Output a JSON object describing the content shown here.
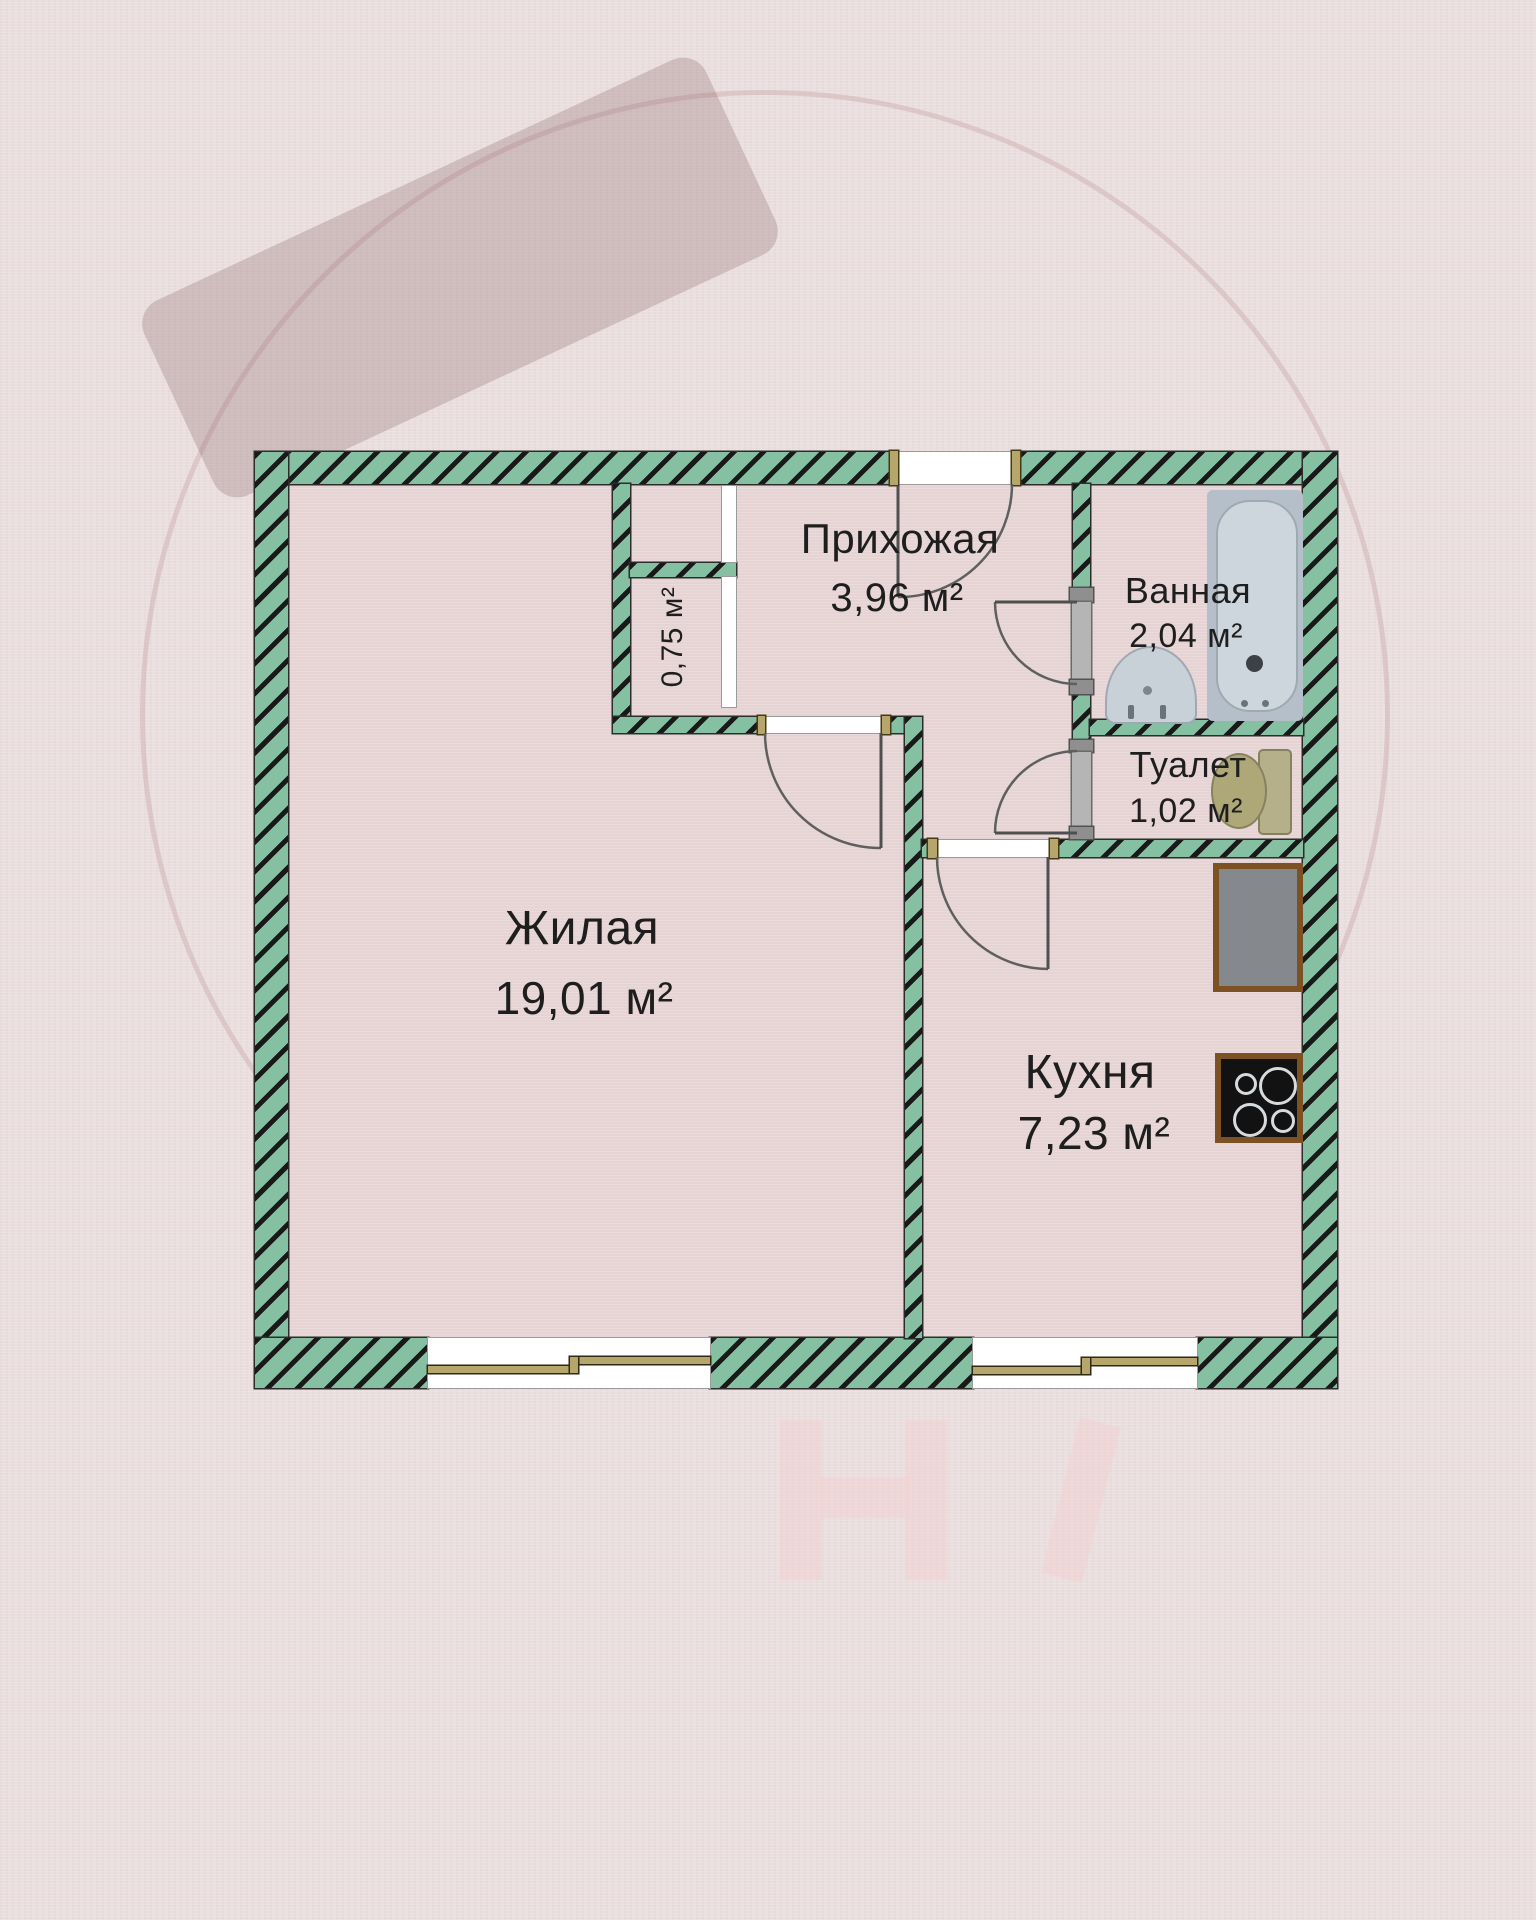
{
  "title": "Floor plan",
  "rooms": [
    {
      "id": "hallway",
      "name": "Прихожая",
      "area": "3,96 м²"
    },
    {
      "id": "bathroom",
      "name": "Ванная",
      "area": "2,04 м²"
    },
    {
      "id": "toilet",
      "name": "Туалет",
      "area": "1,02 м²"
    },
    {
      "id": "living",
      "name": "Жилая",
      "area": "19,01 м²"
    },
    {
      "id": "kitchen",
      "name": "Кухня",
      "area": "7,23 м²"
    },
    {
      "id": "closet",
      "name": "",
      "area": "0,75 м²"
    }
  ],
  "colors": {
    "bg": "#eadedf",
    "room_fill": "#e6d4d5",
    "wall_green": "#85c0a2",
    "jamb_tan": "#b7a66b",
    "text": "#1e1e1e"
  }
}
